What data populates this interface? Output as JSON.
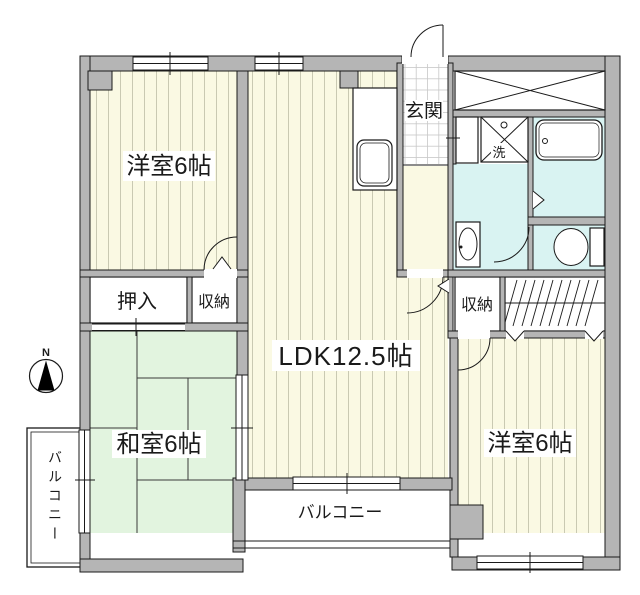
{
  "title": "間取り図",
  "rooms": {
    "bedroom_nw": {
      "label": "洋室6帖"
    },
    "ldk": {
      "label": "LDK12.5帖"
    },
    "entrance": {
      "label": "玄関"
    },
    "oshiire": {
      "label": "押入"
    },
    "storage_left": {
      "label": "収納"
    },
    "storage_right": {
      "label": "収納"
    },
    "washitsu": {
      "label": "和室6帖"
    },
    "bedroom_se": {
      "label": "洋室6帖"
    },
    "laundry": {
      "label": "洗"
    }
  },
  "balconies": {
    "bottom": {
      "label": "バルコニー"
    },
    "left": {
      "label": "バルコニー"
    }
  },
  "compass": {
    "label": "N"
  },
  "colors": {
    "wall": "#b5b5b5",
    "flooring": "#faf9e3",
    "tatami": "#e2f4df",
    "wet_area": "#d9f3f2",
    "outline": "#1a1a1a"
  }
}
